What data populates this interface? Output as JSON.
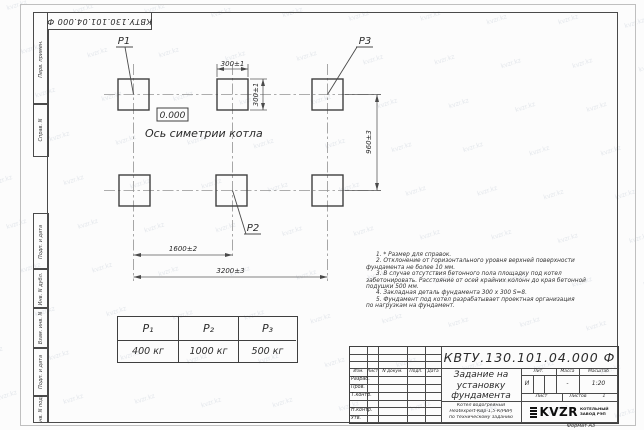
{
  "doc_number": "КВТУ.130.101.04.000 Ф",
  "watermark_text": "kvzr.kz",
  "margin_labels": [
    "Перв. примен.",
    "Справ. N",
    "Подп. и дата",
    "Инв. N дубл.",
    "Взам. инв. N",
    "Подп. и дата",
    "Инв. N подл."
  ],
  "drawing": {
    "p1": "P1",
    "p2": "P2",
    "p3": "P3",
    "dim_pad_width": "300±1",
    "dim_pad_height": "300±1",
    "dim_row_spacing": "960±3",
    "dim_col_spacing": "1600±2",
    "dim_total_width": "3200±3",
    "elevation": "0.000",
    "axis_caption": "Ось симетрии котла"
  },
  "load_table": {
    "headers": [
      "P₁",
      "P₂",
      "P₃"
    ],
    "values": [
      "400 кг",
      "1000 кг",
      "500 кг"
    ]
  },
  "notes": {
    "lines": [
      "1. * Размер для справок.",
      "2. Отклонение от горизонтального уровня верхней поверхности",
      "фундамента не более 10 мм.",
      "3. В случае отсутствия бетонного пола площадку под котел",
      "забетонировать. Расстояние от осей крайних колонн до края бетонной",
      "подушки 500 мм.",
      "4. Закладная деталь фундамента  300 х 300  S=8.",
      "5. Фундамент под котел разрабатывает проектная организация",
      "по нагрузкам на фундамент."
    ]
  },
  "title_block": {
    "header_cols": [
      "Изм.",
      "Лист",
      "N докум.",
      "Подп.",
      "Дата"
    ],
    "sign_rows": [
      "Разраб.",
      "Пров.",
      "Т.контр.",
      "",
      "Н.контр.",
      "Утв."
    ],
    "title_lines": [
      "Задание на",
      "установку",
      "фундамента"
    ],
    "product_lines": [
      "Котел водогрейный",
      "Heatexpert-КВр-1,5-К(РВР)",
      "по техническому заданию"
    ],
    "lit_header": "Лит.",
    "massa_header": "Масса",
    "masshtab_header": "Масштаб",
    "lit_value": "И",
    "massa_value": "-",
    "masshtab_value": "1:20",
    "list_label": "Лист",
    "listov_label": "Листов",
    "listov_value": "1",
    "logo_text": "KVZR",
    "company_lines": [
      "КОТЕЛЬНЫЙ",
      "ЗАВОД РЭП"
    ],
    "format_label": "Формат А3"
  }
}
